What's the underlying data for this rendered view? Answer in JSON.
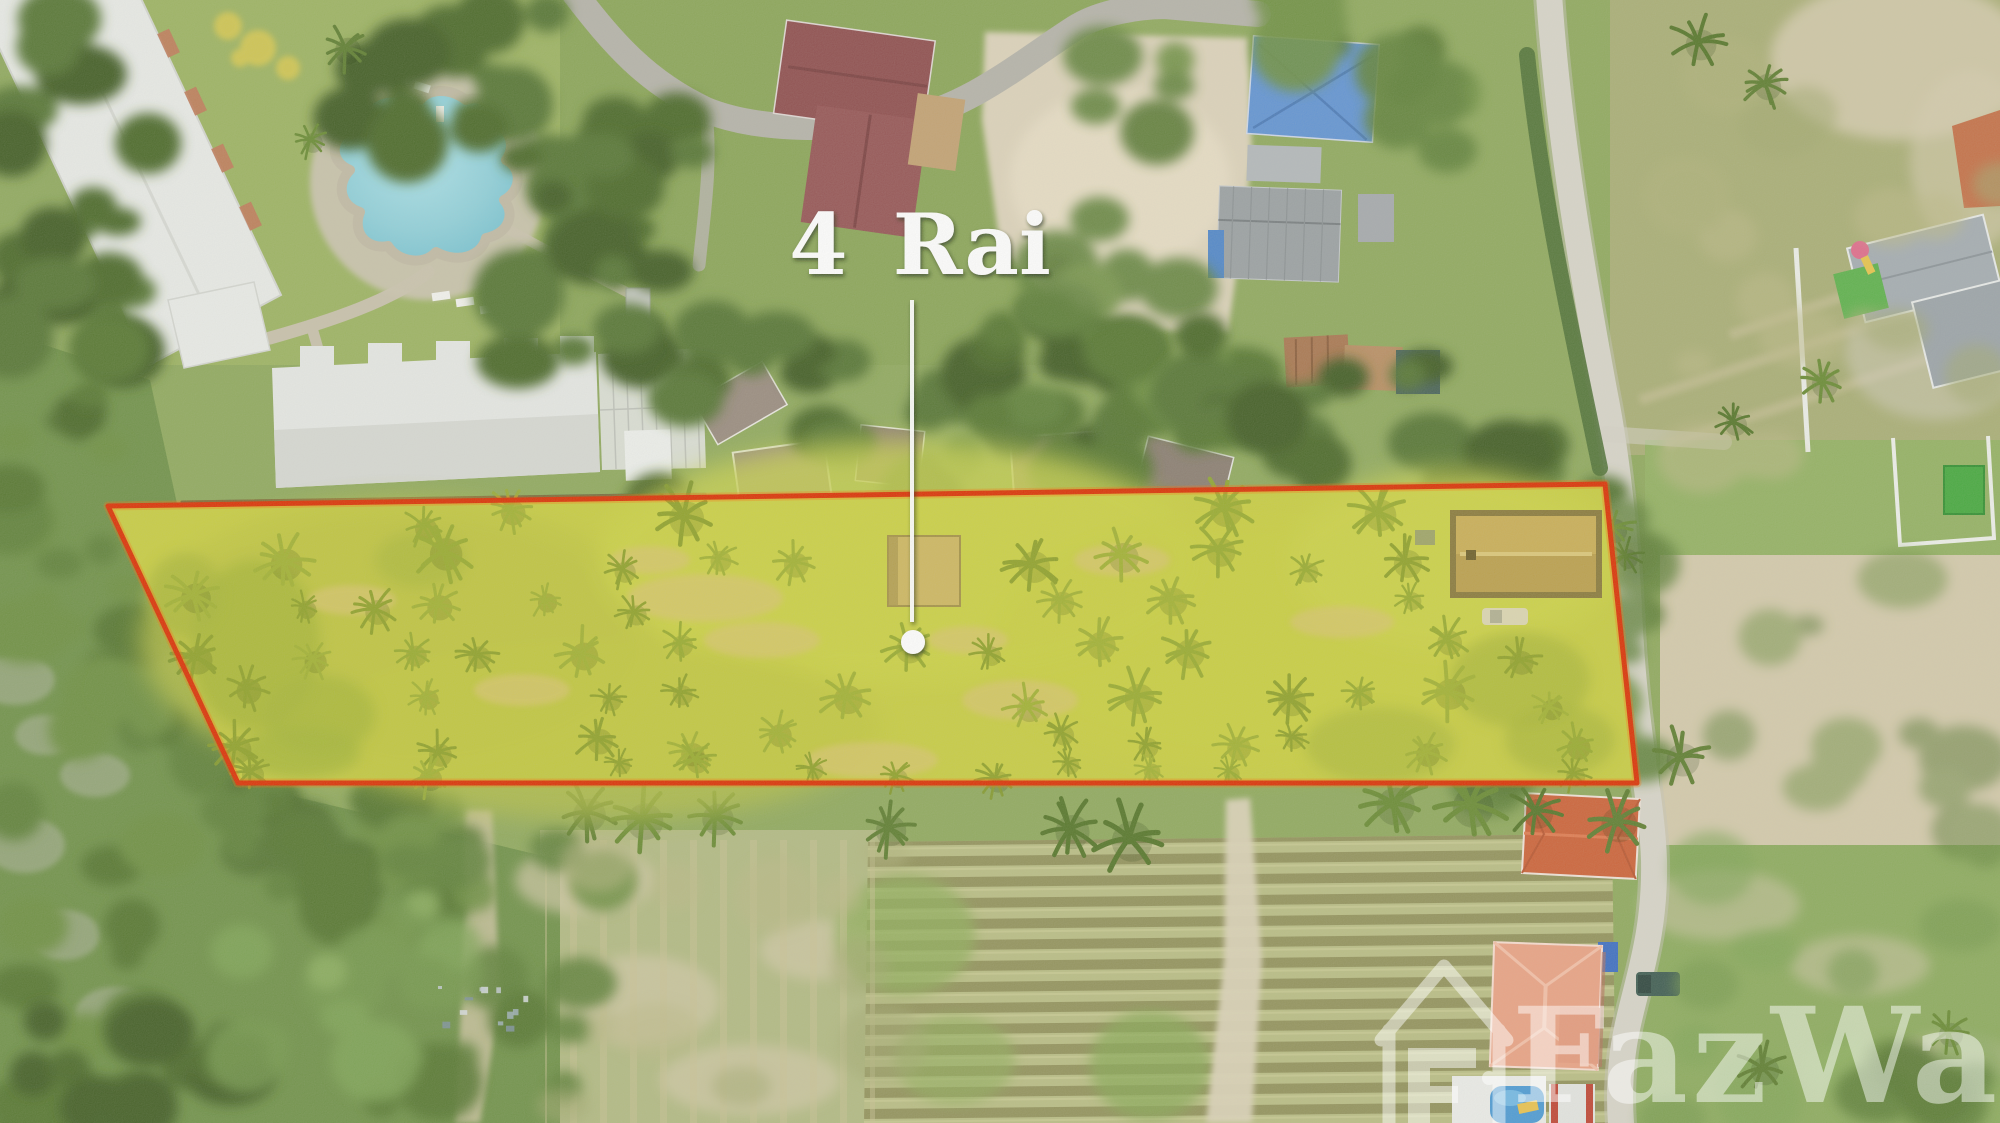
{
  "annotation": {
    "label": "4 Rai",
    "text_color": "#ffffff",
    "leader_line": {
      "x1": 912,
      "y1": 300,
      "x2": 912,
      "y2": 622
    },
    "marker": {
      "cx": 913,
      "cy": 642,
      "r": 12
    }
  },
  "plot": {
    "boundary_points": "108,506 1605,484 1637,783 238,783",
    "boundary_color": "#dc2f00",
    "boundary_glow": "#ff6a00",
    "highlight_fill": "#ffe800",
    "highlight_opacity": 0.1
  },
  "watermark": {
    "text": "FazWaz",
    "icon": "house-outline-icon",
    "color": "#ffffff",
    "opacity": 0.48
  },
  "palette": {
    "grass_base": "#8fa95c",
    "plot_tint": "#c2ca48",
    "pool_blue": "#8fd0da",
    "roof_maroon": "#8e4c4c",
    "roof_blue": "#6093d3",
    "roof_orange": "#cd6136",
    "roof_salmon": "#eaa283",
    "big_shed_tan": "#b49753",
    "road_concrete": "#d8d5c9",
    "sand": "#ddd3ba",
    "forest_green": "#557431",
    "farm_row": "#8e8d56"
  }
}
